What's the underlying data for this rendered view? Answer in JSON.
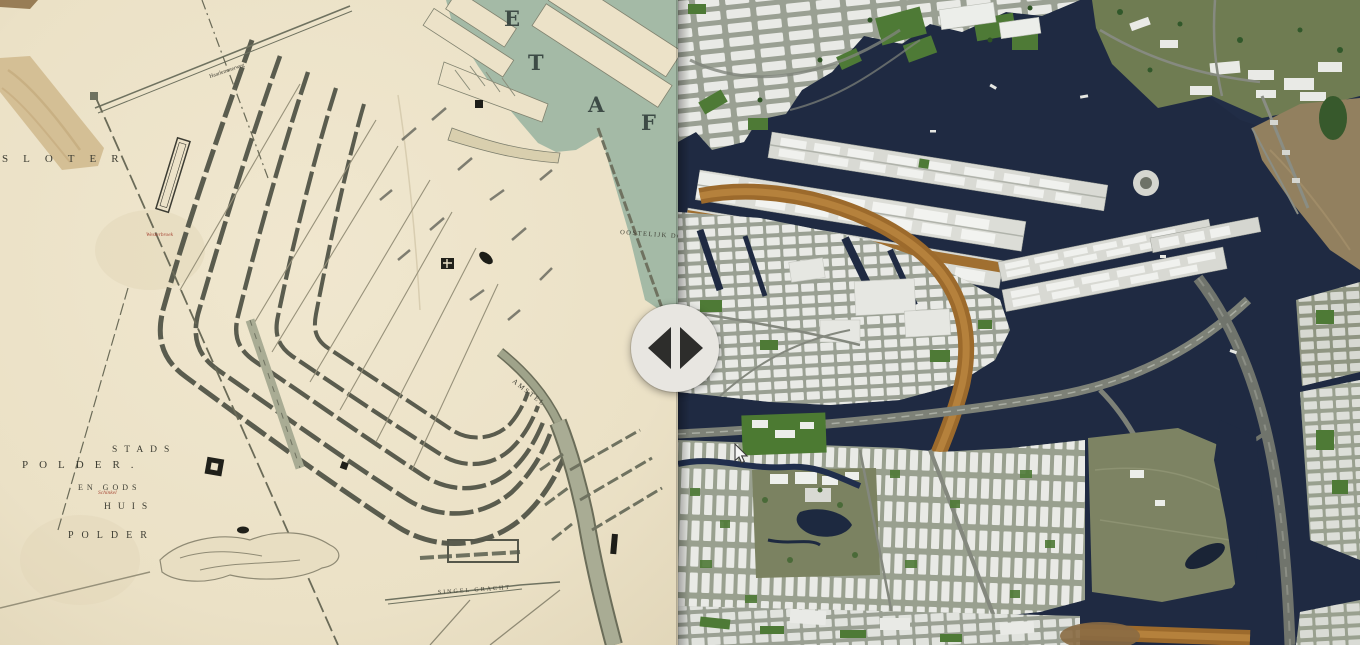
{
  "scene": {
    "type": "before-after map comparison slider",
    "left_pane": "Historical city map of Amsterdam",
    "right_pane": "Modern 3D aerial map of Amsterdam"
  },
  "slider": {
    "position_percent": 49.6,
    "icons": {
      "left": "triangle-left",
      "right": "triangle-right"
    },
    "handle_color": "#e8e6e1",
    "arrow_color": "#2d2d2b"
  },
  "historical_map": {
    "labels": {
      "sloter": "SLOTER",
      "polder_nw": "POLDER.",
      "stads": "STADS",
      "en_gods": "EN GODS",
      "huis": "HUIS",
      "polder_s": "POLDER",
      "amstel": "AMSTEL",
      "oosterdok": "OOSTELIJK DOK",
      "haarlemmerweg": "Haarlemmerweg",
      "singelgracht": "SINGEL GRACHT",
      "red_note_1": "Westerbroek",
      "red_note_2": "Schinkel",
      "ij_letter_1": "E",
      "ij_letter_2": "T",
      "ij_letter_3": "A",
      "ij_letter_4": "F"
    },
    "colors": {
      "paper": "#ece2c8",
      "water": "#a4baa6",
      "ink": "#3d3d33",
      "tape": "#d3bd92",
      "red_accent": "#a84a38"
    }
  },
  "modern_map": {
    "colors": {
      "water": "#1f2a42",
      "building": "#e9eae6",
      "park": "#4c7a32",
      "field": "#7d8363",
      "railway": "#9c6a2c",
      "road": "#7d8177"
    }
  },
  "cursor": {
    "icon": "arrow-pointer"
  }
}
